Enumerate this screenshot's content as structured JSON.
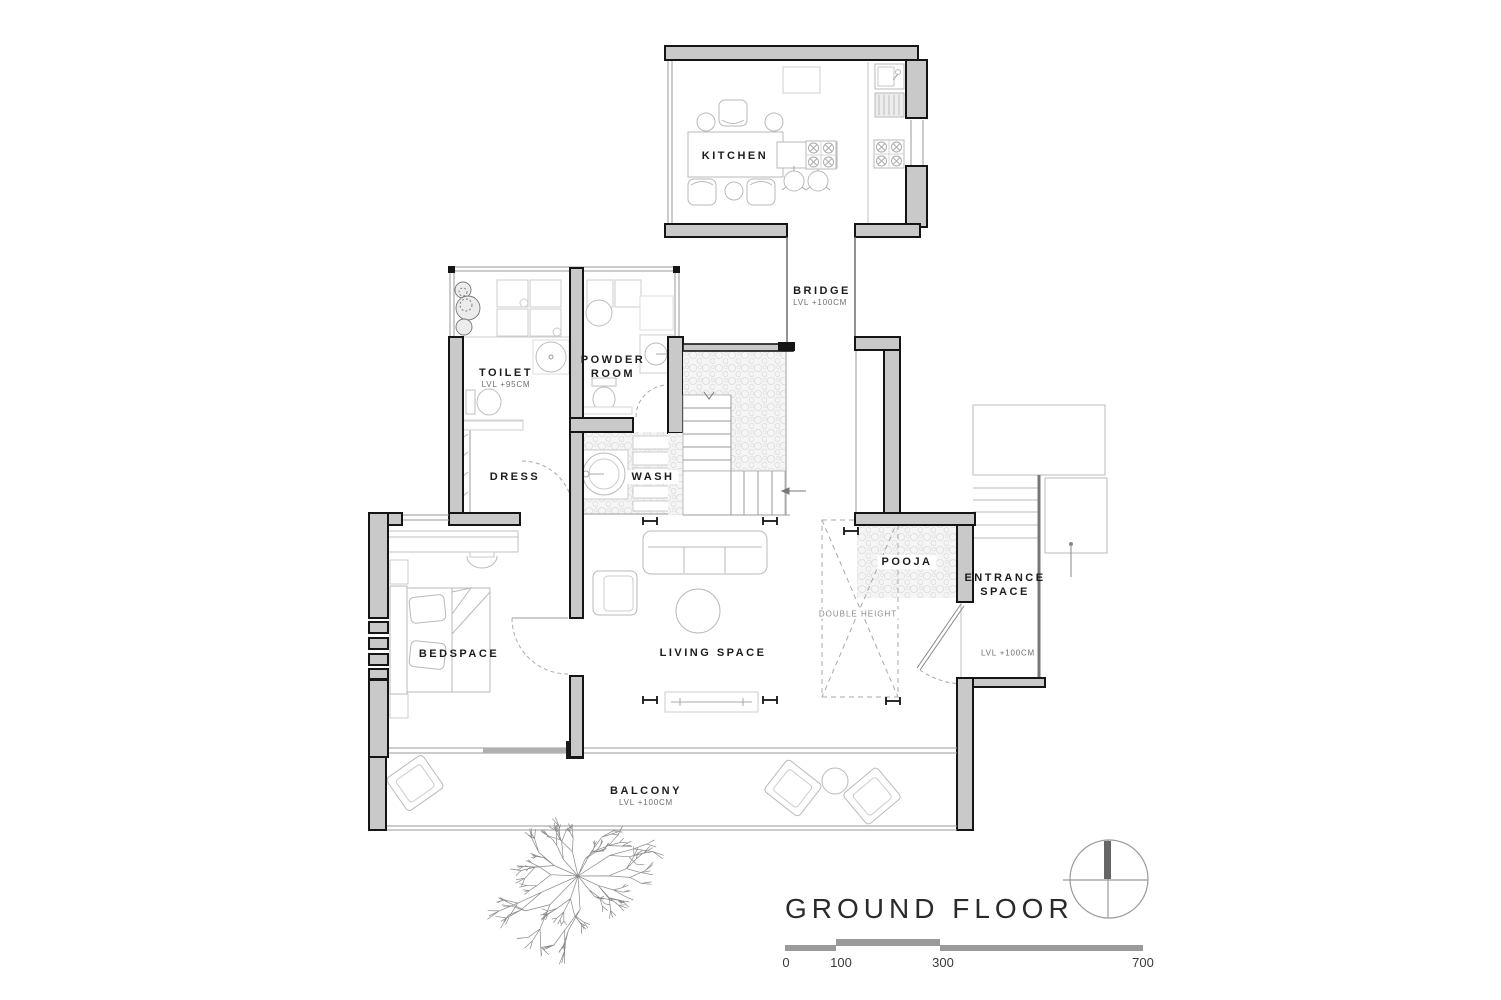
{
  "plan": {
    "type": "floor_plan",
    "title": "GROUND FLOOR",
    "rooms": {
      "kitchen": {
        "label": "KITCHEN"
      },
      "bridge": {
        "label": "BRIDGE",
        "level": "LVL +100CM"
      },
      "toilet": {
        "label": "TOILET",
        "level": "LVL +95CM"
      },
      "powder_room": {
        "label_line1": "POWDER",
        "label_line2": "ROOM"
      },
      "dress": {
        "label": "DRESS"
      },
      "wash": {
        "label": "WASH"
      },
      "pooja": {
        "label": "POOJA"
      },
      "double_height": {
        "label": "DOUBLE HEIGHT"
      },
      "entrance": {
        "label_line1": "ENTRANCE",
        "label_line2": "SPACE",
        "level": "LVL +100CM"
      },
      "living": {
        "label": "LIVING SPACE"
      },
      "bedspace": {
        "label": "BEDSPACE"
      },
      "balcony": {
        "label": "BALCONY",
        "level": "LVL +100CM"
      }
    },
    "scale_bar": {
      "labels": [
        "0",
        "100",
        "300",
        "700"
      ]
    },
    "north_indicator": "north-compass",
    "colors": {
      "wall_fill": "#c9c9c9",
      "wall_outline": "#151515",
      "thin_line": "#b9b9b9",
      "text": "#1c1c1c",
      "scale_bar": "#9a9a9a",
      "background": "#ffffff"
    }
  }
}
